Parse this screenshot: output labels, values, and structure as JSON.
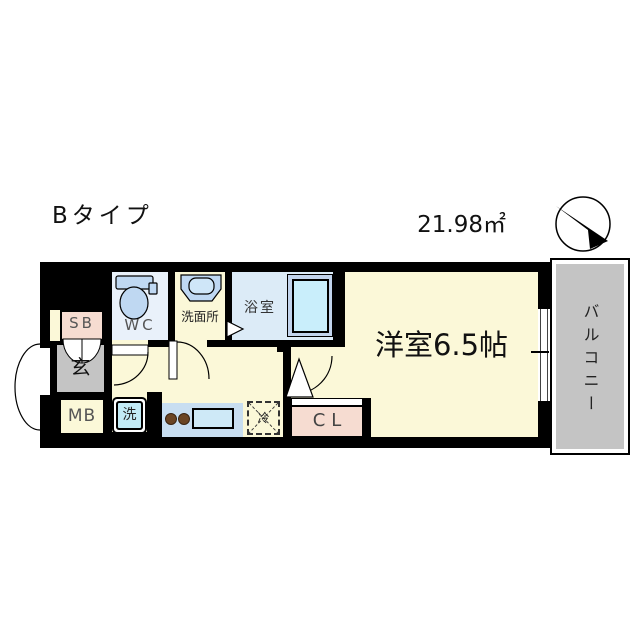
{
  "floorplan": {
    "type_label": "Bタイプ",
    "area": "21.98㎡",
    "rooms": {
      "main": "洋室6.5帖",
      "balcony": "バルコニー",
      "bath": "浴室",
      "washroom": "洗面所",
      "wc": "WC",
      "entrance": "玄",
      "shoe_box": "SB",
      "meter_box": "MB",
      "washer": "洗",
      "fridge": "冷",
      "closet": "CL"
    },
    "colors": {
      "wall": "#000000",
      "floor_cream": "#FBF8D8",
      "bath_blue": "#DCEBF7",
      "wc_blue": "#E9F1FA",
      "fixture_blue": "#BFD8F2",
      "tub_blue": "#C9EEFB",
      "tub_surround": "#C2D4ED",
      "pink": "#F6DCD1",
      "gray": "#C4C4C4",
      "washer_cyan": "#C2EBF6",
      "counter_blue": "#C8DEF1",
      "burner_brown": "#6B4423"
    }
  }
}
